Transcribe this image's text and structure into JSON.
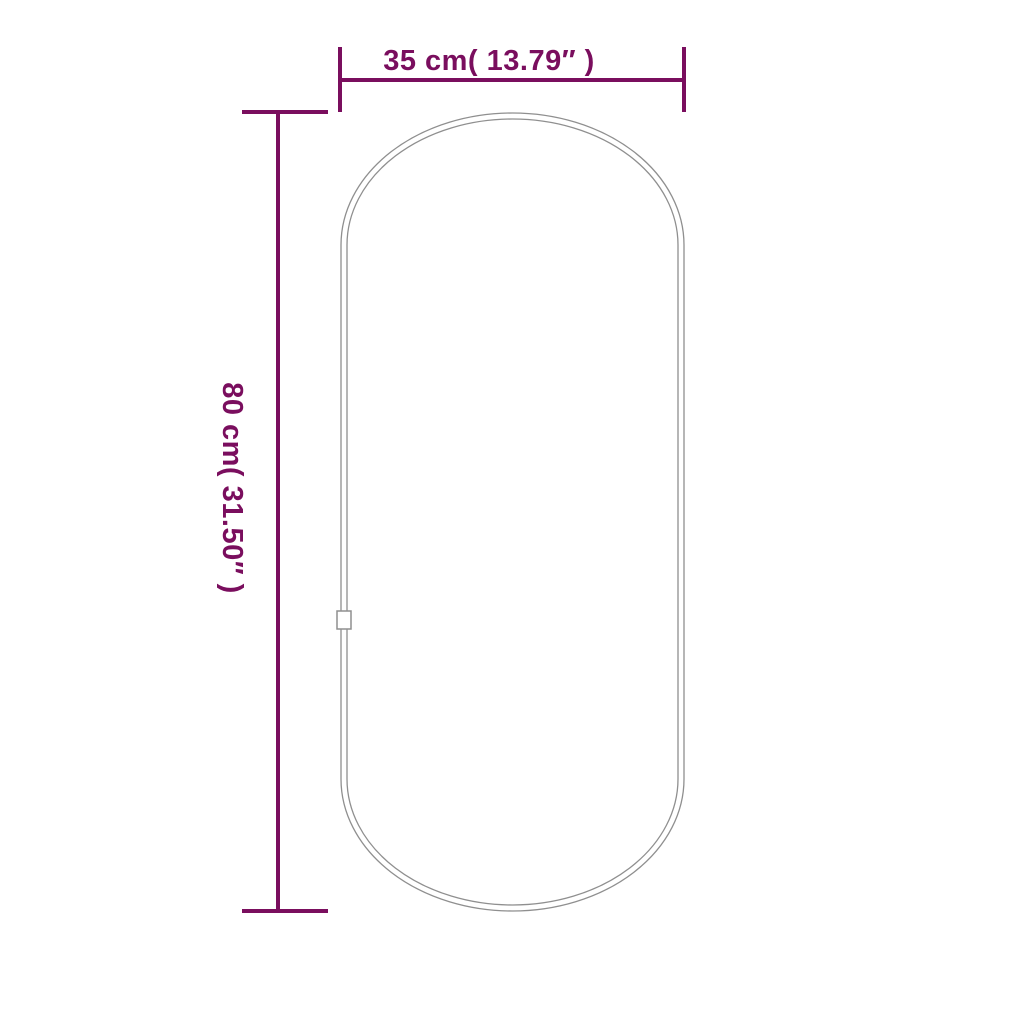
{
  "figure": {
    "name": "oval-mirror-outline",
    "description_labels": {
      "width_label": "35 cm( 13.79″ )",
      "height_label": "80 cm( 31.50″ )"
    }
  },
  "dimensions": {
    "width": {
      "label": "35 cm( 13.79″ )",
      "cm": "35",
      "inches": "13.79"
    },
    "height": {
      "label": "80 cm( 31.50″ )",
      "cm": "80",
      "inches": "31.50"
    }
  },
  "colors": {
    "dimension": "#7A0E5E",
    "outline": "#8F8F8F",
    "background": "#FFFFFF"
  }
}
